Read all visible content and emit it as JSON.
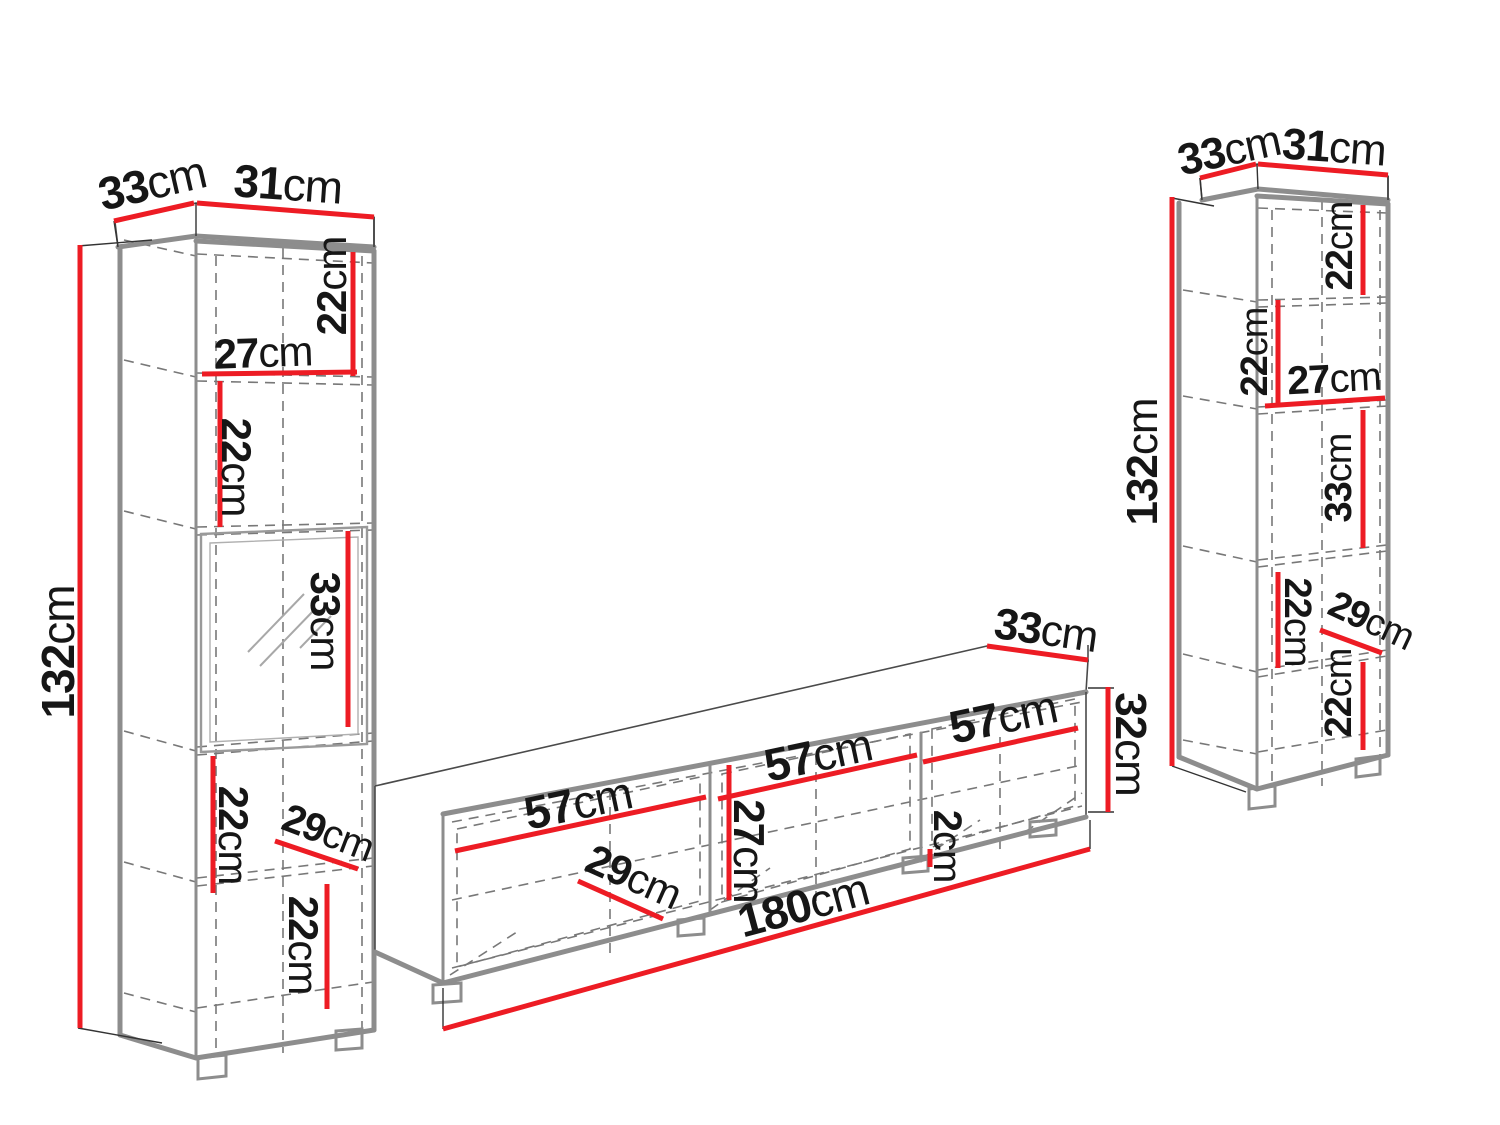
{
  "colors": {
    "dimension_red": "#ed1c24",
    "outline_gray": "#8d8d8d",
    "dash_gray": "#787878",
    "text_black": "#161616"
  },
  "left_cabinet": {
    "top_depth": {
      "num": "33",
      "unit": "cm"
    },
    "top_width": {
      "num": "31",
      "unit": "cm"
    },
    "height": {
      "num": "132",
      "unit": "cm"
    },
    "compartment1_height": {
      "num": "22",
      "unit": "cm"
    },
    "inner_width": {
      "num": "27",
      "unit": "cm"
    },
    "compartment2_height": {
      "num": "22",
      "unit": "cm"
    },
    "glass_section_height": {
      "num": "33",
      "unit": "cm"
    },
    "compartment4_height": {
      "num": "22",
      "unit": "cm"
    },
    "inner_depth": {
      "num": "29",
      "unit": "cm"
    },
    "compartment5_height": {
      "num": "22",
      "unit": "cm"
    }
  },
  "tv_stand": {
    "top_depth": {
      "num": "33",
      "unit": "cm"
    },
    "section1_width": {
      "num": "57",
      "unit": "cm"
    },
    "section2_width": {
      "num": "57",
      "unit": "cm"
    },
    "section3_width": {
      "num": "57",
      "unit": "cm"
    },
    "inner_height": {
      "num": "27",
      "unit": "cm"
    },
    "inner_depth": {
      "num": "29",
      "unit": "cm"
    },
    "door_gap": {
      "num": "2",
      "unit": "cm"
    },
    "total_width": {
      "num": "180",
      "unit": "cm"
    },
    "height": {
      "num": "32",
      "unit": "cm"
    }
  },
  "right_cabinet": {
    "top_depth": {
      "num": "33",
      "unit": "cm"
    },
    "top_width": {
      "num": "31",
      "unit": "cm"
    },
    "height": {
      "num": "132",
      "unit": "cm"
    },
    "compartment1_height": {
      "num": "22",
      "unit": "cm"
    },
    "compartment2_height": {
      "num": "22",
      "unit": "cm"
    },
    "inner_width": {
      "num": "27",
      "unit": "cm"
    },
    "compartment3_height": {
      "num": "33",
      "unit": "cm"
    },
    "compartment4_height": {
      "num": "22",
      "unit": "cm"
    },
    "inner_depth": {
      "num": "29",
      "unit": "cm"
    },
    "compartment5_height": {
      "num": "22",
      "unit": "cm"
    }
  }
}
